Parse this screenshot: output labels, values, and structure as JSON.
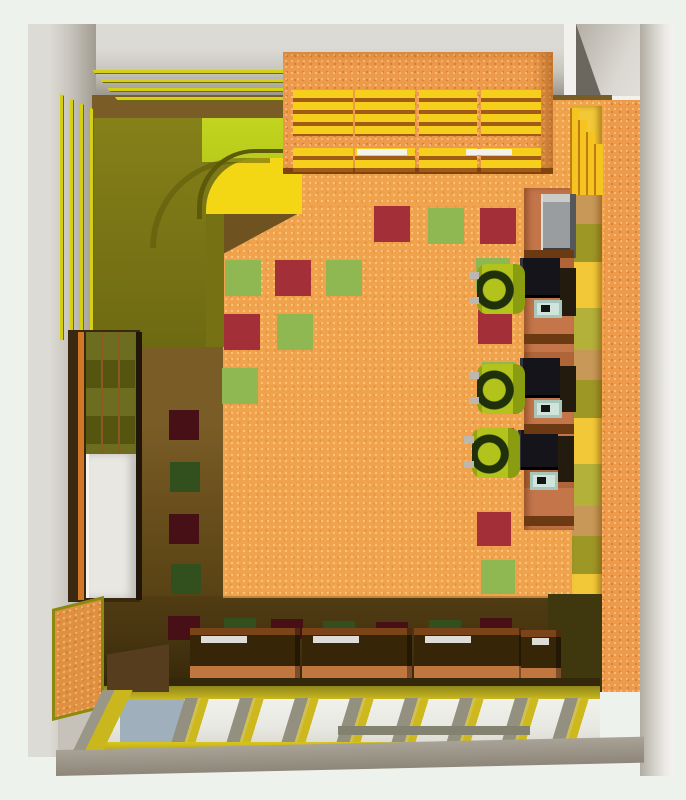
{
  "scene": {
    "kind": "top-down 3d render of a computer classroom interior",
    "colors": {
      "bg": "#eef2ec",
      "wall_light": "#dcdad4",
      "wall_mid": "#c9c6be",
      "wall_dark": "#a19c91",
      "wall_deep": "#8f8a7e",
      "white_soft": "#f2f1ed",
      "floor_lit": "#f0a34c",
      "floor_shadow": "#6e5220",
      "floor_shadow_deep": "#46340f",
      "tile_green_lit": "#8fb852",
      "tile_red_lit": "#a32f38",
      "tile_green_sh": "#31501d",
      "tile_red_sh": "#471016",
      "olive": "#7e7a16",
      "olive_dark": "#5e5a0c",
      "lime": "#b9cc1b",
      "yellow_band": "#f4d714",
      "stripe_yellow": "#d6d014",
      "shelf_orange": "#ee9a4b",
      "shelf_yellow": "#f6cf1d",
      "fin_yellow": "#f6c41e",
      "desk_wood": "#c4754a",
      "desk_dark": "#6b3a12",
      "monitor_dark": "#14141a",
      "keyboard_teal": "#cfe4da",
      "chair_lime": "#b2c41c",
      "chair_dark": "#20300a",
      "table_top_dark": "#372508",
      "table_front": "#c0763f",
      "window_rail": "#cdb91d",
      "glass": "#e9e9e3",
      "glass_blue": "#9fb0bc",
      "mullion_shadow": "#93907f",
      "sill_gray": "#a09a8e",
      "board_orange": "#df9040",
      "tv_gray": "#9a9da0"
    },
    "floor_tiles": [
      {
        "x": 374,
        "y": 206,
        "w": 36,
        "h": 36,
        "c": "tile_red_lit",
        "name": "floor-tile-red"
      },
      {
        "x": 428,
        "y": 208,
        "w": 36,
        "h": 36,
        "c": "tile_green_lit",
        "name": "floor-tile-green"
      },
      {
        "x": 480,
        "y": 208,
        "w": 36,
        "h": 36,
        "c": "tile_red_lit",
        "name": "floor-tile-red"
      },
      {
        "x": 225,
        "y": 260,
        "w": 36,
        "h": 36,
        "c": "tile_green_lit",
        "name": "floor-tile-green"
      },
      {
        "x": 275,
        "y": 260,
        "w": 36,
        "h": 36,
        "c": "tile_red_lit",
        "name": "floor-tile-red"
      },
      {
        "x": 326,
        "y": 260,
        "w": 36,
        "h": 36,
        "c": "tile_green_lit",
        "name": "floor-tile-green"
      },
      {
        "x": 224,
        "y": 314,
        "w": 36,
        "h": 36,
        "c": "tile_red_lit",
        "name": "floor-tile-red"
      },
      {
        "x": 277,
        "y": 314,
        "w": 36,
        "h": 36,
        "c": "tile_green_lit",
        "name": "floor-tile-green"
      },
      {
        "x": 222,
        "y": 368,
        "w": 36,
        "h": 36,
        "c": "tile_green_lit",
        "name": "floor-tile-green"
      },
      {
        "x": 476,
        "y": 258,
        "w": 34,
        "h": 34,
        "c": "tile_green_lit",
        "name": "floor-tile-green"
      },
      {
        "x": 478,
        "y": 310,
        "w": 34,
        "h": 34,
        "c": "tile_red_lit",
        "name": "floor-tile-red"
      },
      {
        "x": 482,
        "y": 362,
        "w": 34,
        "h": 34,
        "c": "tile_green_lit",
        "name": "floor-tile-green"
      },
      {
        "x": 480,
        "y": 428,
        "w": 34,
        "h": 34,
        "c": "tile_red_lit",
        "name": "floor-tile-red"
      },
      {
        "x": 477,
        "y": 512,
        "w": 34,
        "h": 34,
        "c": "tile_red_lit",
        "name": "floor-tile-red"
      },
      {
        "x": 481,
        "y": 560,
        "w": 34,
        "h": 34,
        "c": "tile_green_lit",
        "name": "floor-tile-green"
      },
      {
        "x": 169,
        "y": 410,
        "w": 30,
        "h": 30,
        "c": "tile_red_sh",
        "name": "floor-tile-red-shadow"
      },
      {
        "x": 170,
        "y": 462,
        "w": 30,
        "h": 30,
        "c": "tile_green_sh",
        "name": "floor-tile-green-shadow"
      },
      {
        "x": 169,
        "y": 514,
        "w": 30,
        "h": 30,
        "c": "tile_red_sh",
        "name": "floor-tile-red-shadow"
      },
      {
        "x": 171,
        "y": 564,
        "w": 30,
        "h": 30,
        "c": "tile_green_sh",
        "name": "floor-tile-green-shadow"
      },
      {
        "x": 168,
        "y": 616,
        "w": 32,
        "h": 24,
        "c": "tile_red_sh",
        "name": "floor-tile-red-shadow"
      },
      {
        "x": 224,
        "y": 618,
        "w": 32,
        "h": 22,
        "c": "tile_green_sh",
        "name": "floor-tile-green-shadow"
      },
      {
        "x": 271,
        "y": 619,
        "w": 32,
        "h": 20,
        "c": "tile_red_sh",
        "name": "floor-tile-red-shadow"
      },
      {
        "x": 323,
        "y": 621,
        "w": 32,
        "h": 18,
        "c": "tile_green_sh",
        "name": "floor-tile-green-shadow"
      },
      {
        "x": 376,
        "y": 622,
        "w": 32,
        "h": 16,
        "c": "tile_red_sh",
        "name": "floor-tile-red-shadow"
      },
      {
        "x": 429,
        "y": 620,
        "w": 32,
        "h": 18,
        "c": "tile_green_sh",
        "name": "floor-tile-green-shadow"
      },
      {
        "x": 480,
        "y": 618,
        "w": 32,
        "h": 20,
        "c": "tile_red_sh",
        "name": "floor-tile-red-shadow"
      }
    ],
    "shelf_upper_columns": [
      {
        "x": 293,
        "y": 90,
        "w": 60,
        "h": 46
      },
      {
        "x": 355,
        "y": 90,
        "w": 60,
        "h": 46
      },
      {
        "x": 419,
        "y": 90,
        "w": 58,
        "h": 46
      },
      {
        "x": 481,
        "y": 90,
        "w": 60,
        "h": 46
      }
    ],
    "shelf_lower_columns": [
      {
        "x": 293,
        "y": 148,
        "w": 60,
        "h": 24
      },
      {
        "x": 355,
        "y": 148,
        "w": 60,
        "h": 24
      },
      {
        "x": 419,
        "y": 148,
        "w": 58,
        "h": 24
      },
      {
        "x": 481,
        "y": 148,
        "w": 60,
        "h": 24
      }
    ],
    "monitors": [
      {
        "x": 520,
        "y": 258,
        "w": 40,
        "h": 40
      },
      {
        "x": 520,
        "y": 358,
        "w": 40,
        "h": 40
      },
      {
        "x": 518,
        "y": 430,
        "w": 40,
        "h": 40
      }
    ],
    "towers": [
      {
        "x": 560,
        "y": 268,
        "w": 16,
        "h": 48
      },
      {
        "x": 560,
        "y": 366,
        "w": 16,
        "h": 46
      },
      {
        "x": 558,
        "y": 436,
        "w": 16,
        "h": 46
      }
    ],
    "keyboards": [
      {
        "x": 534,
        "y": 300,
        "w": 28,
        "h": 18
      },
      {
        "x": 534,
        "y": 400,
        "w": 28,
        "h": 18
      },
      {
        "x": 530,
        "y": 472,
        "w": 28,
        "h": 18
      }
    ],
    "chairs": [
      {
        "x": 477,
        "y": 264,
        "w": 48,
        "h": 50
      },
      {
        "x": 477,
        "y": 364,
        "w": 48,
        "h": 50
      },
      {
        "x": 472,
        "y": 428,
        "w": 48,
        "h": 50
      }
    ],
    "bottom_tables": [
      {
        "x": 190,
        "y": 628,
        "w": 110,
        "h": 60
      },
      {
        "x": 302,
        "y": 628,
        "w": 110,
        "h": 60
      },
      {
        "x": 414,
        "y": 628,
        "w": 110,
        "h": 60
      },
      {
        "x": 521,
        "y": 630,
        "w": 40,
        "h": 58
      }
    ],
    "window_mullions": [
      {
        "x": 178,
        "y": 698,
        "w": 30,
        "h": 46
      },
      {
        "x": 233,
        "y": 698,
        "w": 30,
        "h": 46
      },
      {
        "x": 288,
        "y": 698,
        "w": 30,
        "h": 46
      },
      {
        "x": 343,
        "y": 698,
        "w": 30,
        "h": 46
      },
      {
        "x": 398,
        "y": 698,
        "w": 30,
        "h": 46
      },
      {
        "x": 453,
        "y": 698,
        "w": 30,
        "h": 46
      },
      {
        "x": 508,
        "y": 698,
        "w": 30,
        "h": 46
      },
      {
        "x": 558,
        "y": 698,
        "w": 30,
        "h": 46
      }
    ],
    "deco": [
      {
        "x": 357,
        "y": 149,
        "w": 50,
        "h": 6,
        "c": "white_soft",
        "name": "shelf-white-bar"
      },
      {
        "x": 466,
        "y": 149,
        "w": 46,
        "h": 6,
        "c": "white_soft",
        "name": "shelf-white-bar"
      },
      {
        "x": 570,
        "y": 108,
        "w": 9,
        "h": 87,
        "cls": "step",
        "name": "wall-step"
      },
      {
        "x": 578,
        "y": 120,
        "w": 9,
        "h": 75,
        "cls": "step",
        "name": "wall-step"
      },
      {
        "x": 586,
        "y": 132,
        "w": 9,
        "h": 63,
        "cls": "step",
        "name": "wall-step"
      },
      {
        "x": 594,
        "y": 144,
        "w": 9,
        "h": 51,
        "cls": "step",
        "name": "wall-step"
      },
      {
        "x": 541,
        "y": 194,
        "w": 35,
        "h": 64,
        "cls": "tv",
        "name": "tv-display"
      },
      {
        "x": 524,
        "y": 250,
        "w": 50,
        "h": 8,
        "c": "desk_dark",
        "name": "desk-divider"
      },
      {
        "x": 524,
        "y": 334,
        "w": 50,
        "h": 10,
        "c": "desk_dark",
        "name": "desk-divider"
      },
      {
        "x": 524,
        "y": 424,
        "w": 50,
        "h": 10,
        "c": "desk_dark",
        "name": "desk-divider"
      },
      {
        "x": 524,
        "y": 516,
        "w": 50,
        "h": 10,
        "c": "desk_dark",
        "name": "desk-divider"
      },
      {
        "x": 107,
        "y": 644,
        "w": 62,
        "h": 48,
        "c": "#563d1d",
        "css": "clip-path:polygon(0 22%,100% 0,100% 100%,0 100%)",
        "name": "window-corner-shadow"
      },
      {
        "x": 88,
        "y": 690,
        "w": 38,
        "h": 60,
        "cls": "jamb",
        "name": "window-jamb"
      },
      {
        "x": 338,
        "y": 726,
        "w": 192,
        "h": 9,
        "c": "#83816f",
        "name": "sill-bar"
      }
    ]
  }
}
